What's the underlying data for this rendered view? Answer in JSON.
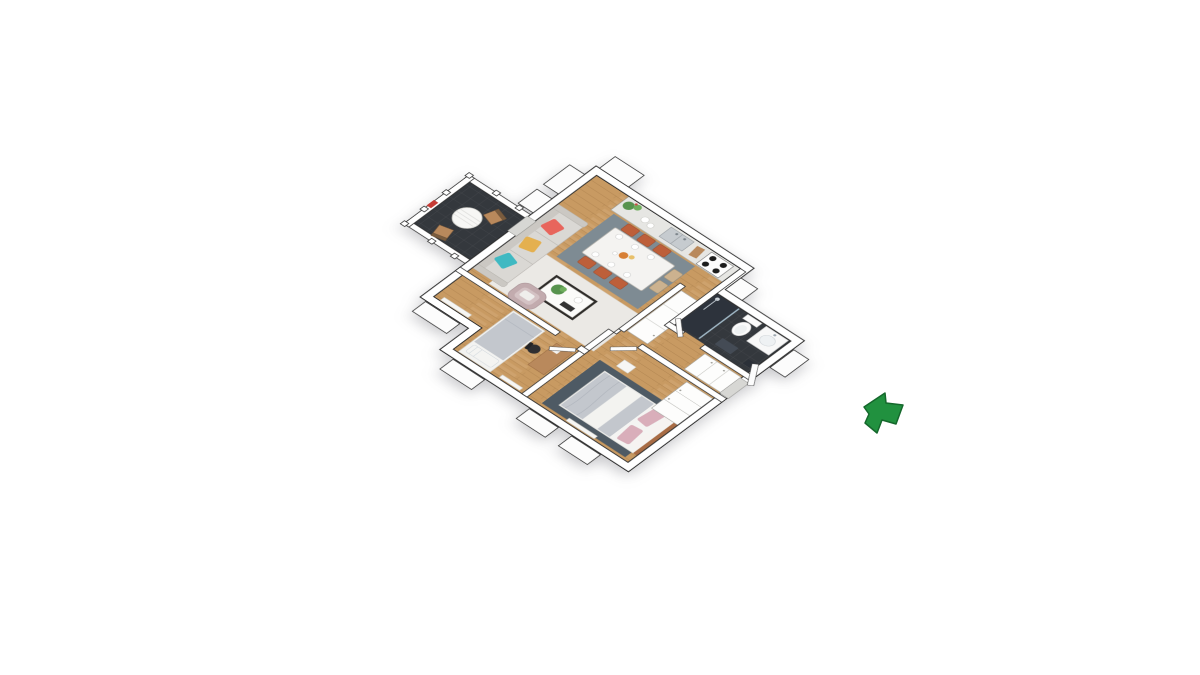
{
  "scene": {
    "kind": "3d-floor-plan-render",
    "view": "axonometric-top-down",
    "background": "#ffffff",
    "visible_text": "none"
  },
  "palette": {
    "wall": "#ffffff",
    "wall_outline": "#2b2b2b",
    "wood_floor": "#c89a62",
    "tile_dark": "#34383d",
    "rug_living": "#ebe9e5",
    "rug_dining": "#7e8b93",
    "rug_master": "#4e5a64",
    "sofa": "#dad8d4",
    "pillow_teal": "#3fb9c2",
    "pillow_yellow": "#e4b04f",
    "pillow_coral": "#e8655c",
    "armchair": "#c2abae",
    "chair_terracotta": "#bd5f3a",
    "chair_beige": "#ccb28f",
    "wood_furniture": "#b9895c",
    "bed_gray": "#c3c7cd",
    "pillow_pink": "#d9aeba",
    "plant_green": "#57934e",
    "arrow_green": "#21913f"
  },
  "rooms": [
    {
      "name": "living-room",
      "floor": "wood + light rug",
      "furniture": [
        "3-seat sofa with teal, yellow and coral pillows",
        "coffee table with plant",
        "mauve armchair",
        "radiator"
      ]
    },
    {
      "name": "dining-area",
      "floor": "wood + slate rug",
      "furniture": [
        "white dining table",
        "6 terracotta chairs",
        "2 beige chairs",
        "plates and centerpiece"
      ]
    },
    {
      "name": "kitchen",
      "floor": "wood",
      "furniture": [
        "counter along north wall",
        "double sink",
        "4-burner stove",
        "potted plant",
        "plates",
        "cutting board"
      ]
    },
    {
      "name": "bathroom",
      "floor": "dark tile",
      "furniture": [
        "walk-in shower with glass panel",
        "toilet",
        "vanity with basin",
        "mirror",
        "bath mat",
        "bin"
      ]
    },
    {
      "name": "hallway-entry",
      "floor": "wood",
      "furniture": [
        "tall wardrobe block",
        "entry wardrobes",
        "open entry door"
      ]
    },
    {
      "name": "small-bedroom",
      "floor": "wood",
      "furniture": [
        "single bed with gray duvet",
        "desk",
        "black office chair",
        "wall frames",
        "radiator"
      ]
    },
    {
      "name": "master-bedroom",
      "floor": "wood + dark slate rug",
      "furniture": [
        "double bed with gray duvet, white runner and pink pillows",
        "wardrobe",
        "nightstand",
        "radiator"
      ]
    },
    {
      "name": "balcony",
      "floor": "dark tile",
      "furniture": [
        "white railing with posts",
        "round white table",
        "2 wooden chairs",
        "red planter"
      ]
    }
  ],
  "entrance": {
    "indicator": "green-arrow",
    "points": "up-left toward open entry door on east wall"
  }
}
